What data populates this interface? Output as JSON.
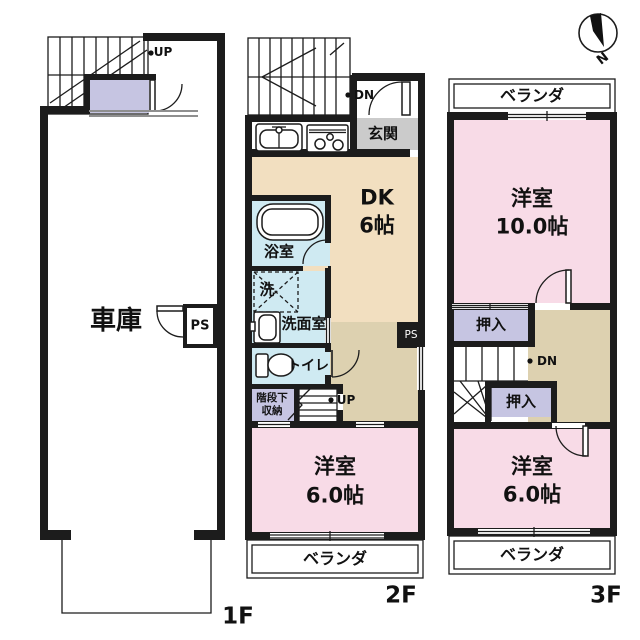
{
  "palette": {
    "wall": "#1c1c1c",
    "room_pink": "#f8dbe7",
    "room_beige": "#f2dfc0",
    "hall_tan": "#ddd1b0",
    "wet_blue": "#cfeaf2",
    "closet_lavender": "#c6c5e2",
    "entrance_gray": "#cbcbcb",
    "line_gray": "#8f8f8f"
  },
  "compass": {
    "north_label": "N"
  },
  "floor1": {
    "floor_label": "1F",
    "stair_up_label": "UP",
    "garage_label": "車庫",
    "ps_label": "PS"
  },
  "floor2": {
    "floor_label": "2F",
    "stair_down_label": "DN",
    "stair_up_label": "UP",
    "entrance_label": "玄関",
    "dk_label_line1": "DK",
    "dk_label_line2": "6帖",
    "bath_label": "浴室",
    "laundry_label": "洗",
    "washroom_label": "洗面室",
    "toilet_label": "トイレ",
    "under_stair_storage_line1": "階段下",
    "under_stair_storage_line2": "収納",
    "bedroom_label_line1": "洋室",
    "bedroom_label_line2": "6.0帖",
    "veranda_label": "ベランダ",
    "ps_label": "PS"
  },
  "floor3": {
    "floor_label": "3F",
    "stair_down_label": "DN",
    "veranda_top_label": "ベランダ",
    "bedroom_large_line1": "洋室",
    "bedroom_large_line2": "10.0帖",
    "closet1_label": "押入",
    "closet2_label": "押入",
    "bedroom_small_line1": "洋室",
    "bedroom_small_line2": "6.0帖",
    "veranda_bottom_label": "ベランダ"
  }
}
